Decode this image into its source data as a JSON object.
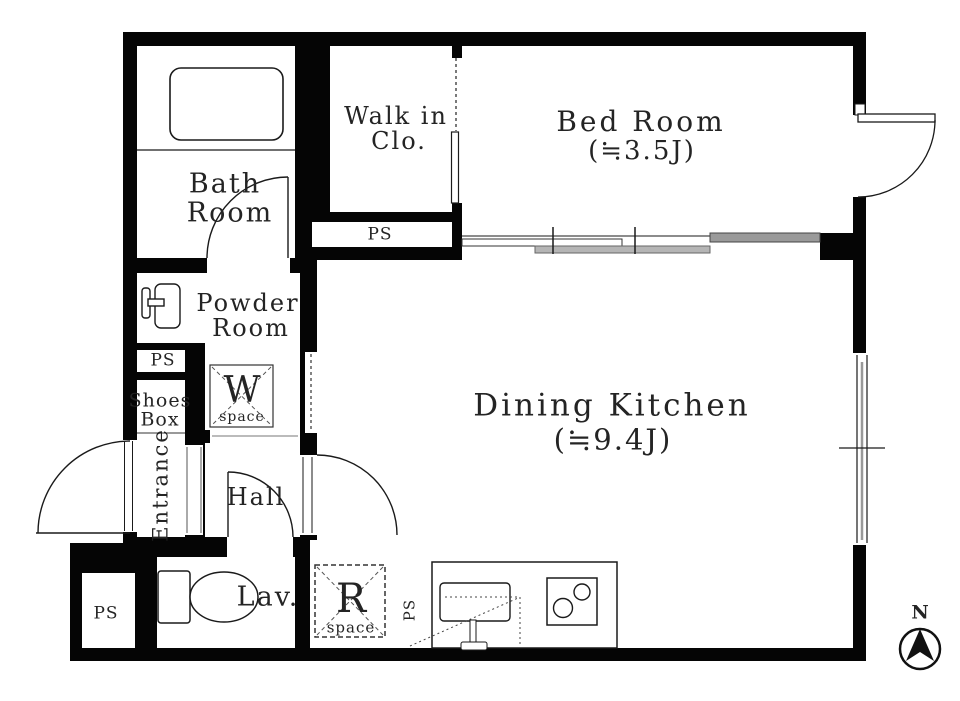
{
  "colors": {
    "wall": "#050505",
    "line": "#1a1a1a",
    "text": "#242424",
    "sliding_panel_light": "#b5b5b5",
    "sliding_panel_dark": "#9a9a9a"
  },
  "rooms": {
    "bath": {
      "line1": "Bath",
      "line2": "Room"
    },
    "walk_in_closet": {
      "line1": "Walk in",
      "line2": "Clo."
    },
    "bed": {
      "name": "Bed Room",
      "size": "(≒3.5J)"
    },
    "powder": {
      "line1": "Powder",
      "line2": "Room"
    },
    "dining_kitchen": {
      "name": "Dining Kitchen",
      "size": "(≒9.4J)"
    },
    "hall": "Hall",
    "entrance": "Entrance",
    "lavatory": "Lav.",
    "shoes_box": {
      "line1": "Shoes",
      "line2": "Box"
    }
  },
  "fixtures": {
    "washer_space": {
      "letter": "W",
      "word": "space"
    },
    "fridge_space": {
      "letter": "R",
      "word": "space"
    }
  },
  "pipe_spaces": {
    "under_closet": "PS",
    "left_column": "PS",
    "bottom_left": "PS",
    "kitchen": "PS"
  },
  "compass": {
    "north": "N"
  }
}
